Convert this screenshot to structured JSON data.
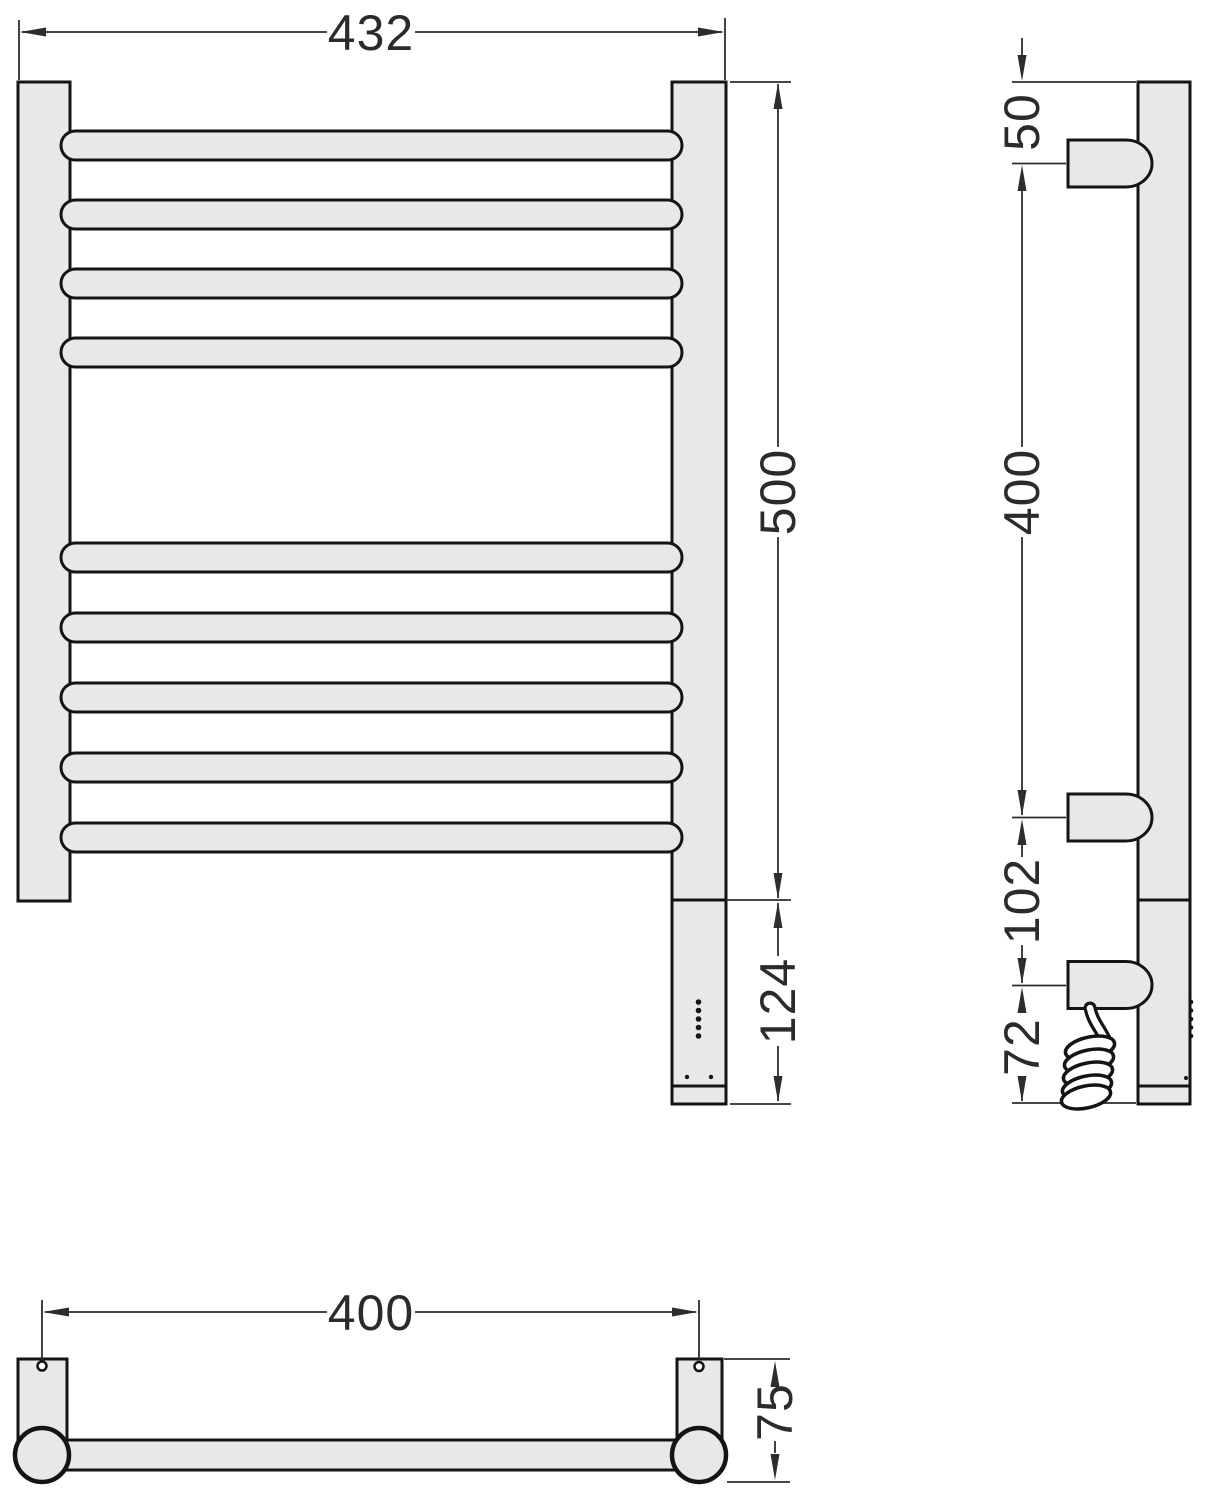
{
  "drawing": {
    "title": "heated towel rail technical drawing",
    "units": "mm",
    "colors": {
      "part_fill": "#e8e8e8",
      "outline": "#141414",
      "dimension": "#2d2d2d",
      "background": "#ffffff",
      "cable_fill": "#ffffff"
    },
    "front_view": {
      "bar_count": 9,
      "led_dot_count": 5,
      "dimensions": {
        "overall_width": "432",
        "rail_height": "500",
        "control_unit_height": "124"
      }
    },
    "side_view": {
      "bracket_count": 3,
      "dimensions": {
        "top_to_bracket": "50",
        "bracket_spacing": "400",
        "bracket_to_power": "102",
        "power_to_bottom": "72"
      }
    },
    "plan_view": {
      "dimensions": {
        "mounting_span": "400",
        "wall_depth": "75"
      }
    }
  }
}
